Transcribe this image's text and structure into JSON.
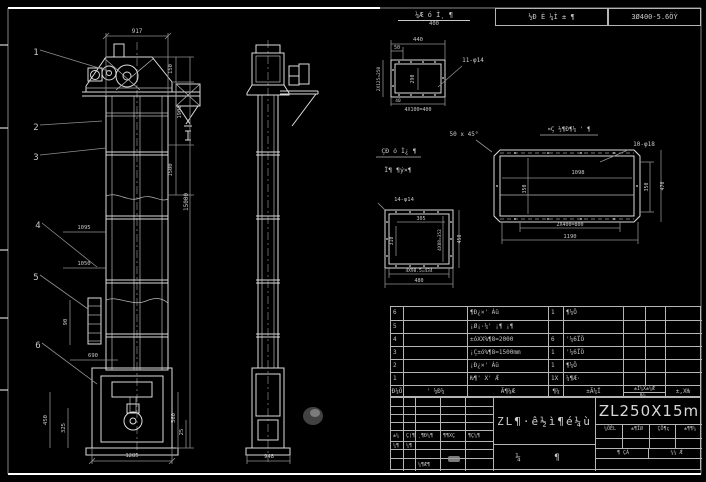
{
  "sheet": {
    "top_note": {
      "numerator": "¼Æ ó Ì¸ ¶",
      "denominator": "400"
    },
    "top_cells": {
      "left": "½Ð È ¼Ì ± ¶",
      "right": "3Ø400-5.6ÖÝ"
    }
  },
  "drawing": {
    "labels": [
      {
        "t": "917",
        "x": 137,
        "y": 33,
        "n": "dim-917"
      },
      {
        "t": "150",
        "x": 172,
        "y": 69,
        "r": -90,
        "s": 5.5
      },
      {
        "t": "1900",
        "x": 181,
        "y": 112,
        "r": -90,
        "s": 5.5
      },
      {
        "t": "1500",
        "x": 172,
        "y": 170,
        "r": -90,
        "s": 5.5
      },
      {
        "t": "15000",
        "x": 188,
        "y": 202,
        "r": -90,
        "s": 6,
        "n": "dim-total-height"
      },
      {
        "t": "1095",
        "x": 84,
        "y": 229,
        "s": 5.5
      },
      {
        "t": "1050",
        "x": 84,
        "y": 265,
        "s": 5.5
      },
      {
        "t": "90",
        "x": 67,
        "y": 322,
        "r": -90,
        "s": 5.5
      },
      {
        "t": "690",
        "x": 93,
        "y": 357,
        "s": 5.5
      },
      {
        "t": "450",
        "x": 47,
        "y": 420,
        "r": -90,
        "s": 5.5
      },
      {
        "t": "325",
        "x": 65,
        "y": 428,
        "r": -90,
        "s": 5.5
      },
      {
        "t": "1285",
        "x": 132,
        "y": 457,
        "s": 5.5
      },
      {
        "t": "360",
        "x": 175,
        "y": 418,
        "r": -90,
        "s": 5.5
      },
      {
        "t": "25",
        "x": 183,
        "y": 432,
        "r": -90,
        "s": 5.5
      },
      {
        "t": "948",
        "x": 269,
        "y": 458,
        "s": 5.5
      },
      {
        "t": "1",
        "x": 36,
        "y": 55,
        "s": 9,
        "n": "balloon-1"
      },
      {
        "t": "2",
        "x": 36,
        "y": 130,
        "s": 9,
        "n": "balloon-2"
      },
      {
        "t": "3",
        "x": 36,
        "y": 160,
        "s": 9,
        "n": "balloon-3"
      },
      {
        "t": "4",
        "x": 38,
        "y": 228,
        "s": 9,
        "n": "balloon-4"
      },
      {
        "t": "5",
        "x": 36,
        "y": 280,
        "s": 9,
        "n": "balloon-5"
      },
      {
        "t": "6",
        "x": 38,
        "y": 348,
        "s": 9,
        "n": "balloon-6"
      },
      {
        "t": "440",
        "x": 418,
        "y": 41,
        "s": 5.5
      },
      {
        "t": "50",
        "x": 397,
        "y": 49,
        "s": 5
      },
      {
        "t": "2X125=250",
        "x": 380,
        "y": 79,
        "r": -90,
        "s": 4.5
      },
      {
        "t": "290",
        "x": 414,
        "y": 79,
        "r": -90,
        "s": 5
      },
      {
        "t": "11-φ14",
        "x": 473,
        "y": 62,
        "s": 6,
        "n": "note-11-phi14"
      },
      {
        "t": "40",
        "x": 398,
        "y": 102,
        "s": 4.5
      },
      {
        "t": "4X100=400",
        "x": 418,
        "y": 111,
        "s": 5
      },
      {
        "t": "50 x 45°",
        "x": 464,
        "y": 136,
        "s": 6,
        "n": "note-chamfer"
      },
      {
        "t": "ÇÐ ó Ì¿ ¶",
        "x": 399,
        "y": 153,
        "s": 6.5,
        "n": "note-garbled-1"
      },
      {
        "t": "Ï¶ ¶ý×¶",
        "x": 398,
        "y": 172,
        "s": 6.5,
        "n": "note-garbled-2"
      },
      {
        "t": "14-φ14",
        "x": 404,
        "y": 201,
        "s": 5.5,
        "n": "note-14-phi14"
      },
      {
        "t": "305",
        "x": 421,
        "y": 220,
        "s": 5
      },
      {
        "t": "310",
        "x": 393,
        "y": 241,
        "r": -90,
        "s": 5
      },
      {
        "t": "4X88=352",
        "x": 441,
        "y": 240,
        "r": -90,
        "s": 4.5
      },
      {
        "t": "450",
        "x": 461,
        "y": 239,
        "r": -90,
        "s": 5
      },
      {
        "t": "4X98.5=434",
        "x": 419,
        "y": 272,
        "s": 4.5
      },
      {
        "t": "480",
        "x": 419,
        "y": 282,
        "s": 5
      },
      {
        "t": "¤Ç ½¶Ð¶¼ ' ¶",
        "x": 569,
        "y": 131,
        "s": 6,
        "n": "note-garbled-3"
      },
      {
        "t": "10-φ18",
        "x": 644,
        "y": 146,
        "s": 6,
        "n": "note-10-phi18"
      },
      {
        "t": "1098",
        "x": 578,
        "y": 174,
        "s": 5.5
      },
      {
        "t": "350",
        "x": 526,
        "y": 189,
        "r": -90,
        "s": 5
      },
      {
        "t": "350",
        "x": 648,
        "y": 187,
        "r": -90,
        "s": 5
      },
      {
        "t": "470",
        "x": 664,
        "y": 186,
        "r": -90,
        "s": 5
      },
      {
        "t": "2X400=800",
        "x": 570,
        "y": 226,
        "s": 5
      },
      {
        "t": "1190",
        "x": 570,
        "y": 238,
        "s": 5.5
      }
    ]
  },
  "bom": {
    "headers": [
      "Ð¼Ö",
      "' ¼Ð¼",
      "Ã¶¼Æ",
      "¶¼",
      "±Ã¼Ï",
      "±Ï¼X±¼Æ",
      "Ƕ¼¸",
      "±,XǶ"
    ],
    "rows": [
      {
        "no": "6",
        "desc": "¶Ð¿×' Áü",
        "qty": "1",
        "mat": "¶¼Ö"
      },
      {
        "no": "5",
        "desc": "¡Ø¡·¼' ¡¶ ¡¶",
        "qty": "",
        "mat": ""
      },
      {
        "no": "4",
        "desc": "±óXX%¶8=2000",
        "qty": "6",
        "mat": "'¼6ÏÖ"
      },
      {
        "no": "3",
        "desc": "¡Ç±ó%¶8=1500mm",
        "qty": "1",
        "mat": "'¼6ÏÖ"
      },
      {
        "no": "2",
        "desc": "¡Ð¿×' Áü",
        "qty": "1",
        "mat": "¶¼Ö"
      },
      {
        "no": "1",
        "desc": "Ƕ¶' X' Ǽ",
        "qty": "1X",
        "mat": "¼¶Æ·"
      }
    ]
  },
  "titleblock": {
    "drawing_title": "ZL¶·ê½ì¶é¼ù",
    "model": "ZL250X15m",
    "small_headers": [
      "¼ÖÊL",
      "±¶ÏØ",
      "ÇÖ¶ç",
      "±¶¶¼"
    ],
    "approve_left": "¶ ÇÁ",
    "approve_right": "¼¼ Ǽ",
    "bottom_center": "¼ ¶",
    "left_rows": [
      [
        "",
        "",
        "",
        "",
        ""
      ],
      [
        "",
        "",
        "",
        "",
        ""
      ],
      [
        "",
        "",
        "",
        "",
        ""
      ],
      [
        "",
        "",
        "",
        "",
        ""
      ],
      [
        "±¼",
        "Ç(¶",
        "¸¶Ð¼¶",
        "¶¶XÇ",
        "¶Ç¼¶"
      ],
      [
        "¼¶",
        "¼¶",
        "",
        "",
        ""
      ],
      [
        "",
        "",
        "",
        "",
        ""
      ],
      [
        "",
        "",
        "¼¶Æ¶",
        "",
        ""
      ]
    ]
  }
}
